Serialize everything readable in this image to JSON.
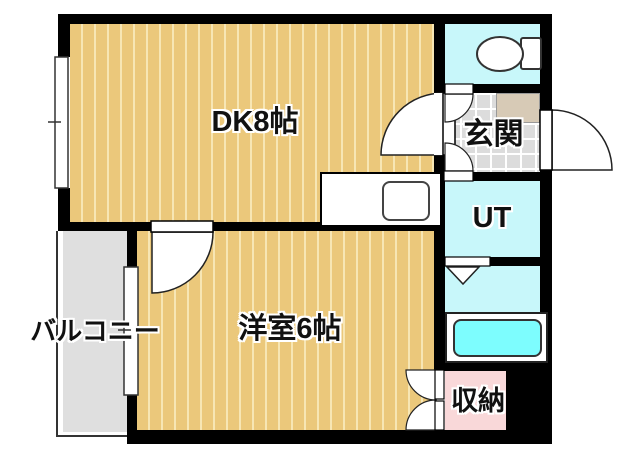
{
  "page": {
    "type": "apartment-floor-plan"
  },
  "rooms": {
    "dk": {
      "label": "DK8帖"
    },
    "western_room": {
      "label": "洋室6帖"
    },
    "entrance": {
      "label": "玄関"
    },
    "utility": {
      "label": "UT"
    },
    "storage": {
      "label": "収納"
    },
    "balcony": {
      "label": "バルコニー"
    }
  },
  "colors": {
    "wall": "#000000",
    "room_floor": "#ebc87b",
    "floor_stripe": "#f7e6b4",
    "wet_area": "#c8f7fa",
    "bathtub": "#7dfdfe",
    "storage_pink": "#f9d8d9",
    "entrance_tile": "#dcdcdc",
    "shoe_cabinet": "#d7cab6",
    "balcony": "#dfdfdf"
  }
}
